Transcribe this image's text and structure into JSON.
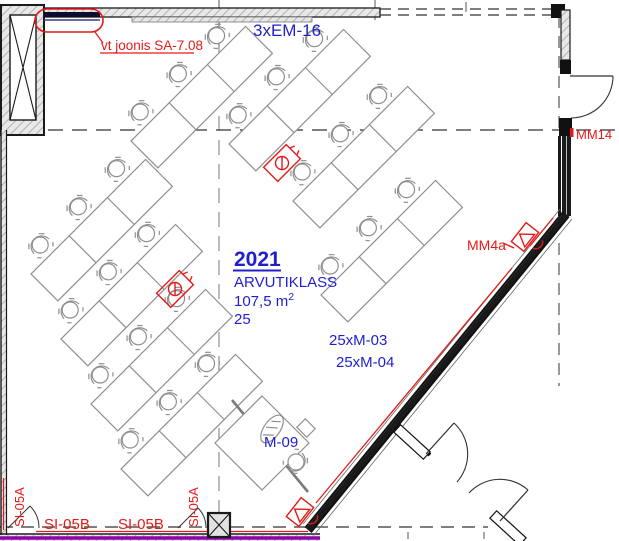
{
  "room": {
    "number": "2021",
    "name": "ARVUTIKLASS",
    "area_base": "107,5 m",
    "area_sup": "2",
    "seats": "25"
  },
  "annotations": {
    "cable_top": "3xEM-16",
    "revision": "vt joonis SA-7.08",
    "monitors_1": "25xM-03",
    "monitors_2": "25xM-04",
    "teacher_unit": "M-09",
    "door_tag": "MM14",
    "wall_tag": "MM4a",
    "tray_b1": "SI-05B",
    "tray_b2": "SI-05B",
    "tray_a_left": "SI-05A",
    "tray_a_mid": "SI-05A"
  },
  "symbols": {
    "shaft": "ventilation-shaft",
    "outlet": "floor-outlet-symbol",
    "wall_device": "wall-device-symbol",
    "revision_cloud": "revision-cloud"
  },
  "colors": {
    "annotation_blue": "#1f1fd0",
    "annotation_red": "#e41a1a",
    "cable_purple": "#8b07a8",
    "wall_black": "#1a1a1a",
    "furniture_gray": "#8f8f8f"
  }
}
